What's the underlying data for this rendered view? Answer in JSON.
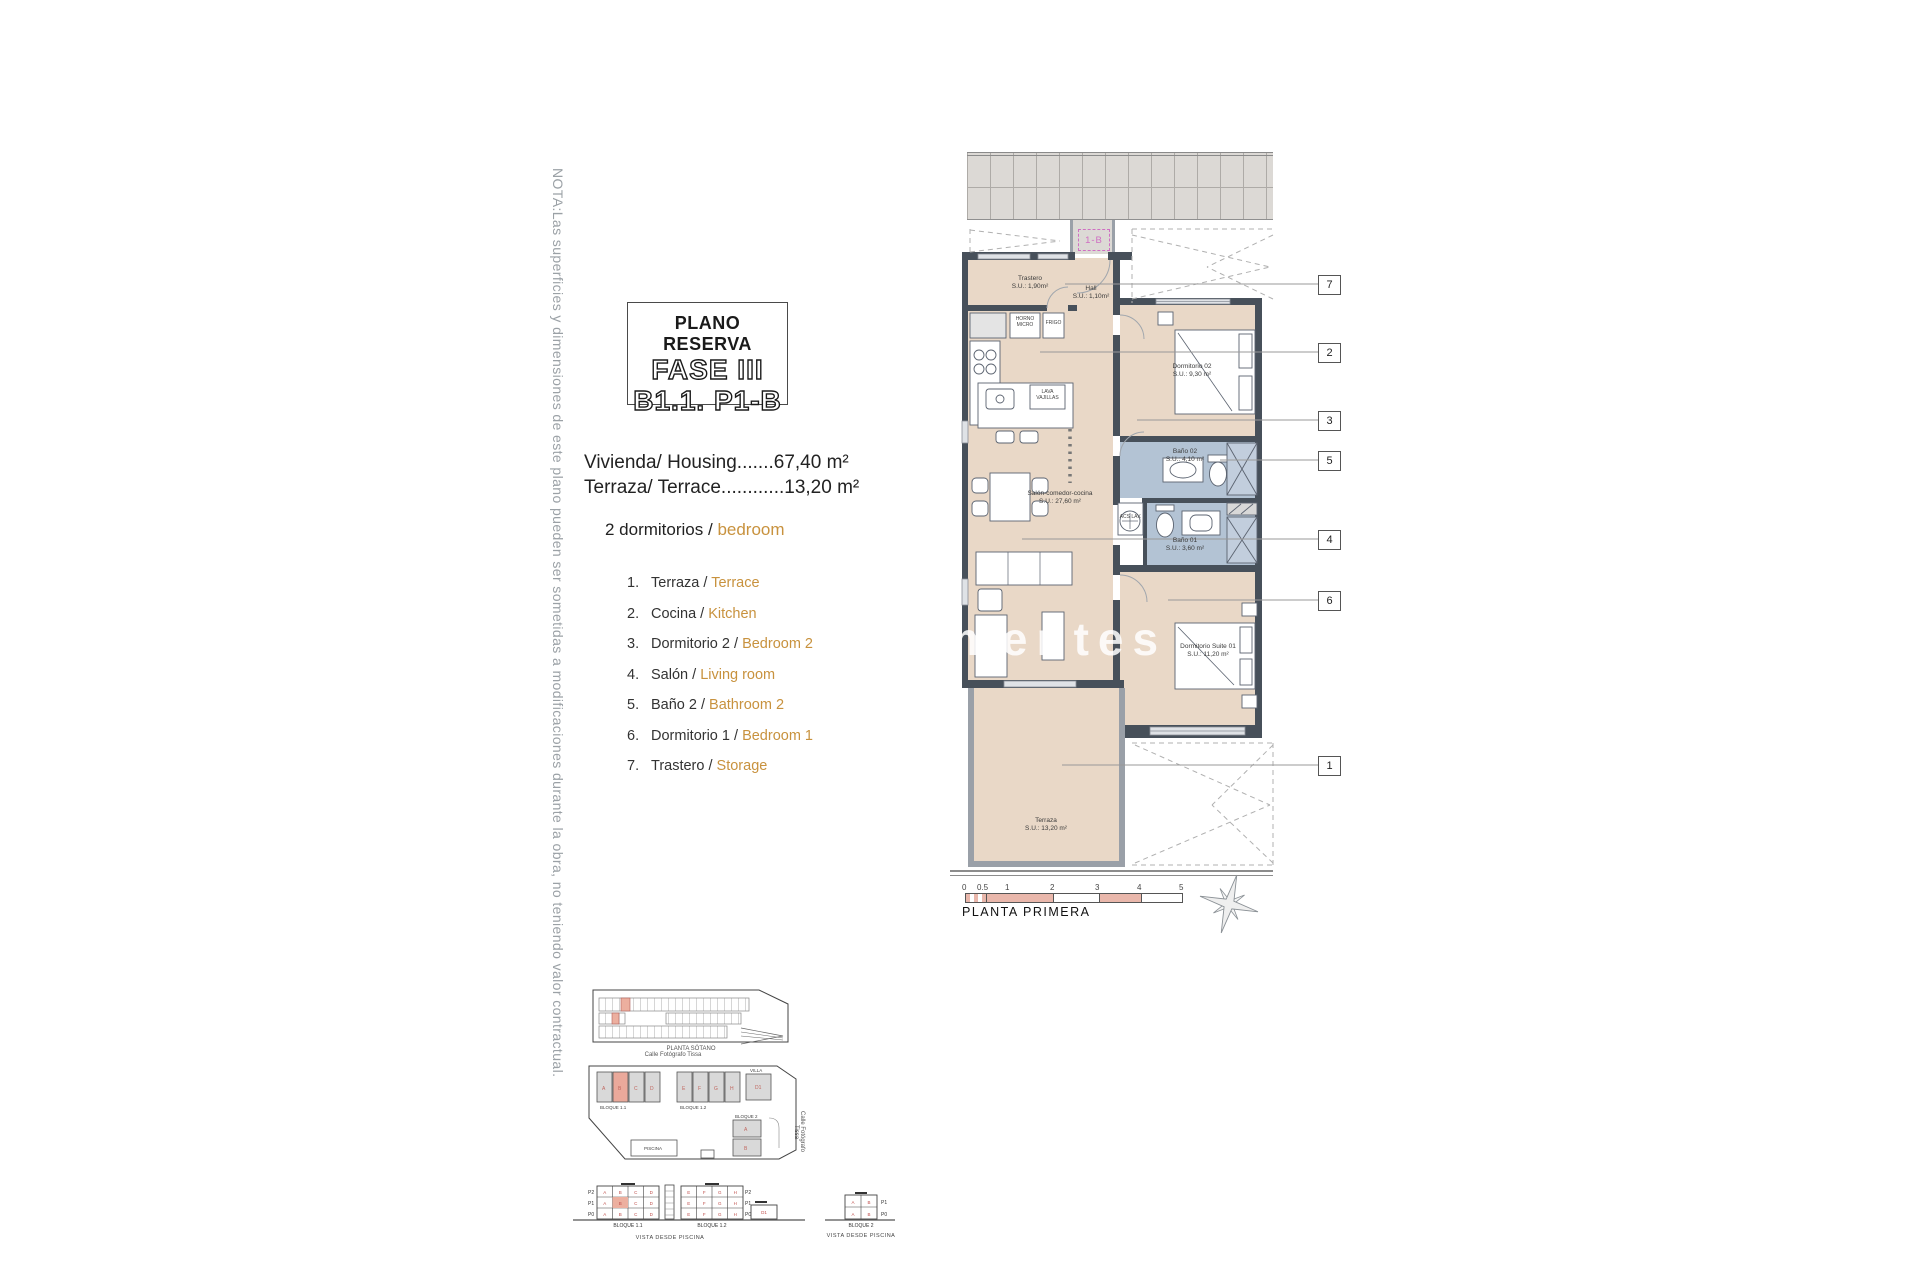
{
  "note": "NOTA:Las superficies y dimensiones de este plano pueden ser sometidas a modificaciones durante la obra, no teniendo valor contractual.",
  "title": {
    "header": "PLANO RESERVA",
    "phase": "FASE III",
    "unit": "B1.1. P1-B"
  },
  "summary": {
    "housing": "Vivienda/ Housing.......67,40 m²",
    "terrace": "Terraza/ Terrace............13,20 m²",
    "bedrooms_es": "2 dormitorios /",
    "bedrooms_en": "bedroom"
  },
  "legend": [
    {
      "n": "1.",
      "es": "Terraza /",
      "en": "Terrace"
    },
    {
      "n": "2.",
      "es": "Cocina /",
      "en": "Kitchen"
    },
    {
      "n": "3.",
      "es": "Dormitorio 2 /",
      "en": "Bedroom 2"
    },
    {
      "n": "4.",
      "es": "Salón /",
      "en": "Living room"
    },
    {
      "n": "5.",
      "es": "Baño 2 /",
      "en": "Bathroom 2"
    },
    {
      "n": "6.",
      "es": "Dormitorio 1 /",
      "en": "Bedroom 1"
    },
    {
      "n": "7.",
      "es": "Trastero /",
      "en": "Storage"
    }
  ],
  "plan": {
    "unit_tag": "1-B",
    "rooms": {
      "trastero": {
        "name": "Trastero",
        "area": "S.U.: 1,90m²"
      },
      "hall": {
        "name": "Hall",
        "area": "S.U.: 1,10m²"
      },
      "dorm02": {
        "name": "Dormitorio 02",
        "area": "S.U.: 9,30 m²"
      },
      "salon": {
        "name": "Salón-comedor-cocina",
        "area": "S.U.: 27,60 m²"
      },
      "bano02": {
        "name": "Baño 02",
        "area": "S.U.: 4,10 m²"
      },
      "bano01": {
        "name": "Baño 01",
        "area": "S.U.: 3,60 m²"
      },
      "suite": {
        "name": "Dormitorio Suite 01",
        "area": "S.U.: 11,20 m²"
      },
      "terraza": {
        "name": "Terraza",
        "area": "S.U.: 13,20 m²"
      }
    },
    "labels": {
      "horno": "HORNO MICRO",
      "frigo": "FRIGO",
      "lavavajillas": "LAVA VAJILLAS",
      "aclav": "ACS LAV."
    },
    "callouts": [
      "7",
      "2",
      "3",
      "5",
      "4",
      "6",
      "1"
    ],
    "scale": {
      "ticks": [
        "0",
        "0.5",
        "1",
        "2",
        "3",
        "4",
        "5"
      ]
    },
    "floor_label": "PLANTA PRIMERA"
  },
  "watermark": "mentes",
  "bottom": {
    "garage_label": "PLANTA SÓTANO",
    "street_top": "Calle Fotógrafo Tissa",
    "street_right": "Calle Fotógrafo Tissa",
    "site": {
      "bloque11": "BLOQUE 1.1",
      "bloque12": "BLOQUE 1.2",
      "bloque2": "BLOQUE 2",
      "villa": "VILLA",
      "piscina": "PISCINA"
    },
    "elev": {
      "bloque11": "BLOQUE 1.1",
      "bloque12": "BLOQUE 1.2",
      "bloque2": "BLOQUE 2",
      "vista": "VISTA DESDE PISCINA",
      "rows": [
        "P2",
        "P1",
        "P0"
      ],
      "rows2": [
        "P1",
        "P0"
      ],
      "letters1": [
        "A",
        "B",
        "C",
        "D"
      ],
      "letters2": [
        "E",
        "F",
        "G",
        "H"
      ],
      "letters3": [
        "A",
        "B"
      ],
      "villa_unit": "D1"
    }
  },
  "colors": {
    "room_beige": "#e9d8c7",
    "bath_blue": "#b3c3d4",
    "wall": "#47505a",
    "accent_orange": "#c8923e",
    "scale_pink": "#e9b7ab",
    "tag_pink": "#cf6ec2"
  }
}
